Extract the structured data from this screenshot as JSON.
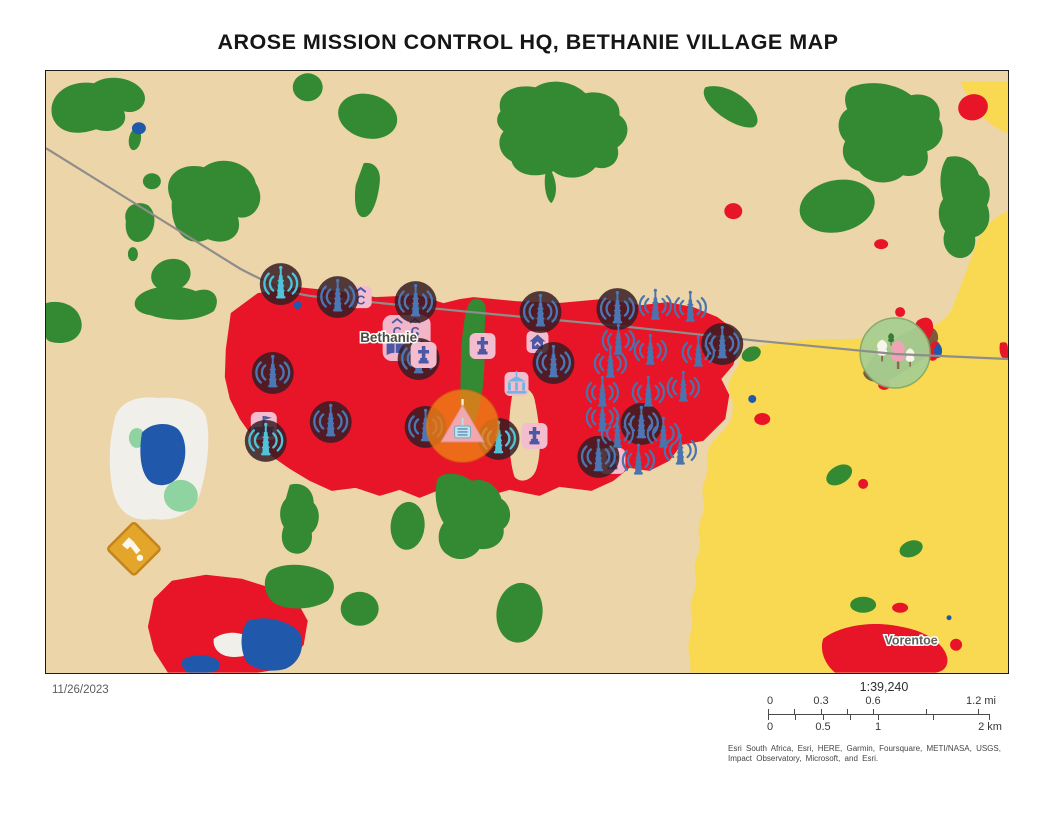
{
  "title": "AROSE MISSION CONTROL HQ, BETHANIE VILLAGE MAP",
  "date": "11/26/2023",
  "scale": {
    "ratio": "1:39,240",
    "miles": {
      "labels": [
        "0",
        "0.3",
        "0.6",
        "1.2 mi"
      ]
    },
    "km": {
      "labels": [
        "0",
        "0.5",
        "1",
        "2 km"
      ]
    }
  },
  "attribution": {
    "line1": "Esri South Africa, Esri, HERE, Garmin, Foursquare, METI/NASA, USGS,",
    "line2": "Impact Observatory, Microsoft, and Esri."
  },
  "map": {
    "labels": [
      {
        "text": "Bethanie"
      },
      {
        "text": "Vorentoe"
      }
    ],
    "icon_letters": {
      "c": "C"
    },
    "colors": {
      "landTan": "#ecd5a9",
      "vegetation": "#338a33",
      "builtRed": "#e81529",
      "cropYellow": "#f8d951",
      "waterBlue": "#2059ab",
      "panWhite": "#f1efe9",
      "panGreen": "#8fd4a0",
      "roadGray": "#8f8d8a",
      "markerDark": "#351c22",
      "towerBlue": "#4b77b5",
      "towerTeal": "#4fc3d9",
      "towerSteel": "#4a74ae",
      "badgePink": "#f3bdcf",
      "badgeBlue": "#4a58a5",
      "bankBlue": "#6cb7e3",
      "hqOrange": "#ee7e16",
      "mineAmber": "#e4a62a",
      "mineBorder": "#c4841c",
      "parkFill": "#a8cf92",
      "parkRim": "#83a969",
      "treePink": "#f0a3b5",
      "brown": "#7d5a3a"
    },
    "markers": [
      {
        "type": "community",
        "x": 361,
        "y": 267
      },
      {
        "type": "c-badge",
        "x": 315,
        "y": 226
      },
      {
        "type": "school",
        "x": 218,
        "y": 355
      },
      {
        "type": "house",
        "x": 492,
        "y": 271
      },
      {
        "type": "bank",
        "x": 471,
        "y": 313
      },
      {
        "type": "church",
        "x": 437,
        "y": 275
      },
      {
        "type": "church",
        "x": 489,
        "y": 365
      },
      {
        "type": "church",
        "x": 567,
        "y": 390
      },
      {
        "type": "tower-dark-teal",
        "x": 235,
        "y": 213
      },
      {
        "type": "tower-dark",
        "x": 292,
        "y": 226
      },
      {
        "type": "tower-dark",
        "x": 370,
        "y": 231
      },
      {
        "type": "tower-dark",
        "x": 495,
        "y": 241
      },
      {
        "type": "tower-dark",
        "x": 572,
        "y": 238
      },
      {
        "type": "tower-dark",
        "x": 677,
        "y": 273
      },
      {
        "type": "tower-dark",
        "x": 227,
        "y": 302
      },
      {
        "type": "tower-dark",
        "x": 285,
        "y": 351
      },
      {
        "type": "tower-dark",
        "x": 380,
        "y": 356
      },
      {
        "type": "tower-dark",
        "x": 508,
        "y": 292
      },
      {
        "type": "tower-dark",
        "x": 553,
        "y": 386
      },
      {
        "type": "tower-dark",
        "x": 596,
        "y": 353
      },
      {
        "type": "tower-dark-teal",
        "x": 220,
        "y": 370
      },
      {
        "type": "tower-dark-teal",
        "x": 453,
        "y": 368
      },
      {
        "type": "tower-dark",
        "x": 373,
        "y": 288
      },
      {
        "type": "tower-light",
        "x": 610,
        "y": 235
      },
      {
        "type": "tower-light",
        "x": 645,
        "y": 237
      },
      {
        "type": "tower-light",
        "x": 573,
        "y": 270
      },
      {
        "type": "tower-light",
        "x": 605,
        "y": 280
      },
      {
        "type": "tower-light",
        "x": 653,
        "y": 282
      },
      {
        "type": "tower-light",
        "x": 565,
        "y": 293
      },
      {
        "type": "tower-light",
        "x": 638,
        "y": 317
      },
      {
        "type": "tower-light",
        "x": 603,
        "y": 322
      },
      {
        "type": "tower-light",
        "x": 557,
        "y": 322
      },
      {
        "type": "tower-light",
        "x": 557,
        "y": 347
      },
      {
        "type": "tower-light",
        "x": 572,
        "y": 363
      },
      {
        "type": "tower-light",
        "x": 618,
        "y": 363
      },
      {
        "type": "tower-light",
        "x": 635,
        "y": 380
      },
      {
        "type": "tower-light",
        "x": 593,
        "y": 390
      },
      {
        "type": "church",
        "x": 378,
        "y": 284
      },
      {
        "type": "mine",
        "x": 88,
        "y": 478
      },
      {
        "type": "hq",
        "x": 417,
        "y": 355
      },
      {
        "type": "park",
        "x": 850,
        "y": 282,
        "layer": "under-road"
      }
    ]
  }
}
